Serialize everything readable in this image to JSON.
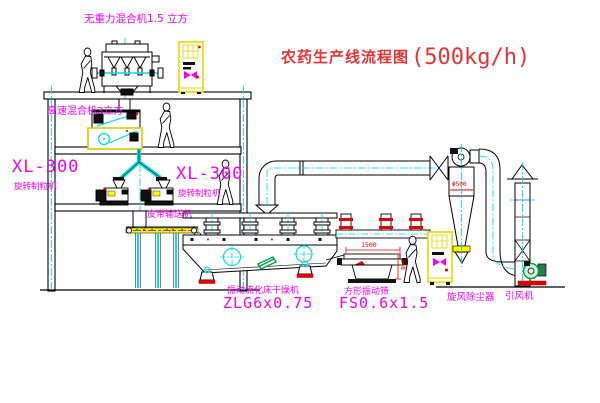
{
  "title": {
    "cn": "农药生产线流程图",
    "capacity": "(500kg/h)"
  },
  "labels": {
    "gravity_mixer": "无重力混合机1.5 立方",
    "speed_mixer": "高速混合机3立方",
    "granulator_left_model": "XL-300",
    "granulator_left_name": "旋转制粒机",
    "granulator_right_model": "XL-300",
    "granulator_right_name": "旋转制粒机",
    "belt_conveyor": "皮带输送机",
    "dryer_name": "振动流化床干燥机",
    "dryer_model": "ZLG6x0.75",
    "sieve_name": "方形振动筛",
    "sieve_model": "FS0.6x1.5",
    "cyclone": "旋风除尘器",
    "fan": "引风机"
  },
  "dimensions": {
    "sieve_length": "1500",
    "sieve_height": "540",
    "cyclone_dia": "Φ500"
  },
  "colors": {
    "label_magenta": "#FF00FF",
    "annotation_red": "#FF0000",
    "equipment_yellow": "#FFFF00",
    "centerline_cyan": "#00FFFF",
    "detail_green": "#00AA44",
    "line_black": "#000000",
    "background": "#FFFFFF"
  }
}
